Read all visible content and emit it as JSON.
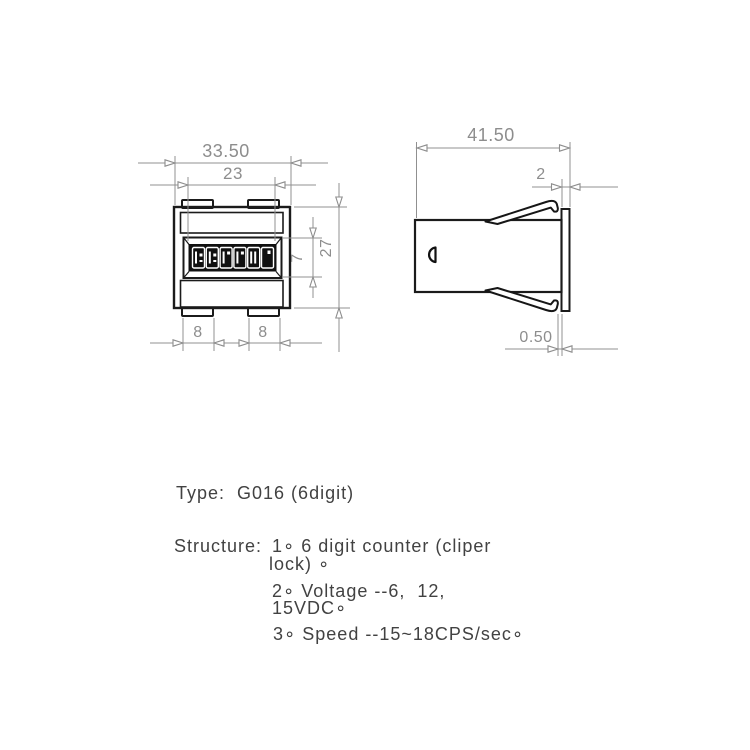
{
  "page": {
    "background": "#ffffff"
  },
  "drawing": {
    "views": [
      "front-view",
      "side-view"
    ],
    "display": {
      "digit_count": 6
    },
    "dimensions": {
      "front": {
        "overall_width": "33.50",
        "window_width": "23",
        "window_height": "7",
        "body_height": "27",
        "tab_left": "8",
        "tab_right": "8"
      },
      "side": {
        "overall_depth": "41.50",
        "flange_depth": "2",
        "flange_thickness": "0.50"
      }
    },
    "colors": {
      "outline": "#1b1b1b",
      "dimension_lines": "#909090",
      "dimension_text": "#8d8d8d",
      "display_background": "#101010",
      "note_text": "#424242"
    }
  },
  "title_block": {
    "type_line": "Type:  G016 (6digit)",
    "structure_label": "Structure:",
    "structure_items": [
      {
        "lines": [
          "1∘ 6 digit counter (cliper",
          "lock) ∘"
        ]
      },
      {
        "lines": [
          "2∘ Voltage --6,  12,",
          "15VDC∘"
        ]
      },
      {
        "lines": [
          "3∘ Speed --15~18CPS/sec∘"
        ]
      }
    ]
  }
}
